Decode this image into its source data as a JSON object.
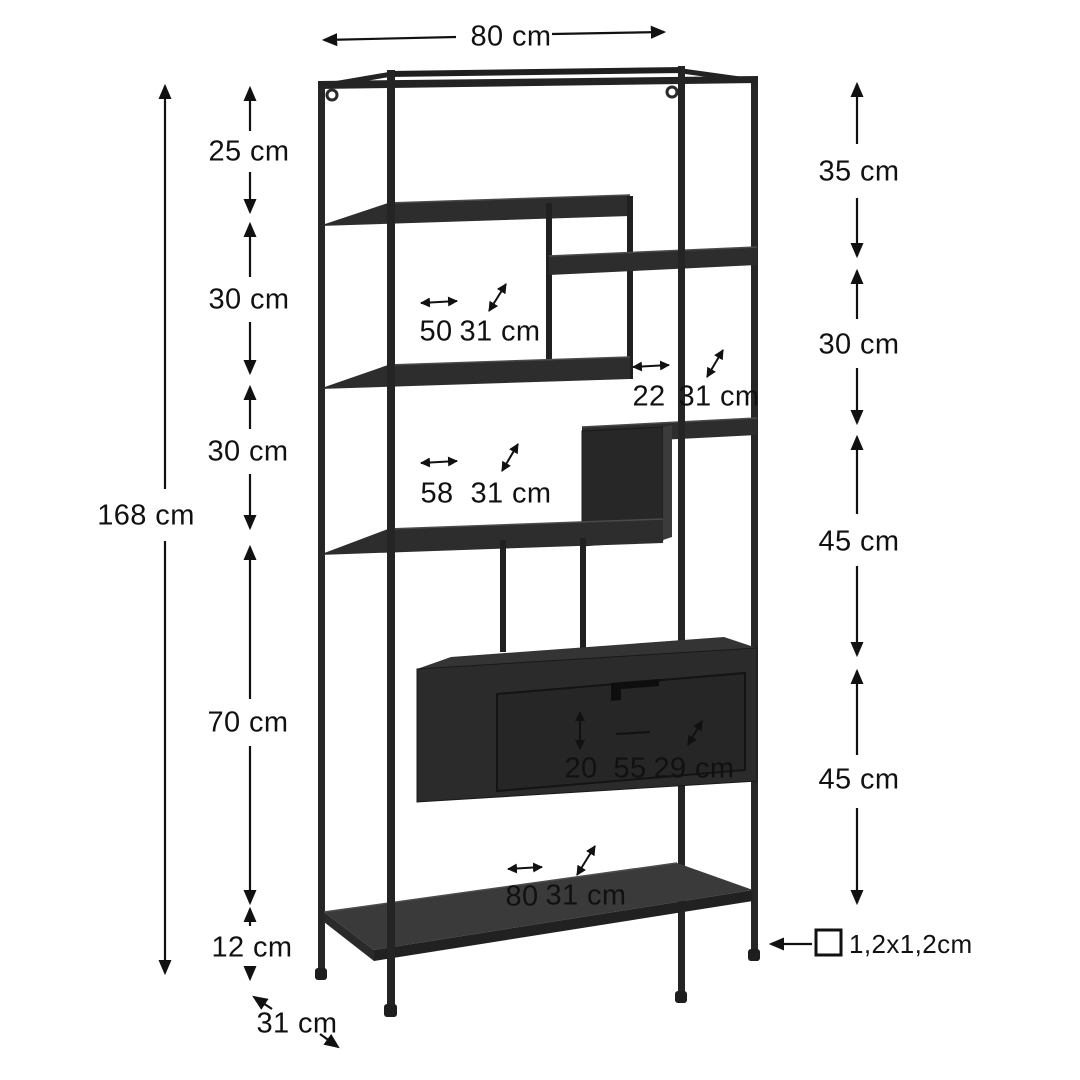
{
  "diagram": {
    "width_label": "80 cm",
    "height_label": "168 cm",
    "depth_label": "31 cm",
    "tube_label": "1,2x1,2cm",
    "left_segments": [
      "25 cm",
      "30 cm",
      "30 cm",
      "70 cm",
      "12 cm"
    ],
    "right_segments": [
      "35 cm",
      "30 cm",
      "45 cm",
      "45 cm"
    ],
    "annotations": [
      {
        "width": "50",
        "depth": "31 cm"
      },
      {
        "width": "22",
        "depth": "31 cm"
      },
      {
        "width": "58",
        "depth": "31 cm"
      },
      {
        "height": "20",
        "width": "55",
        "depth": "29 cm"
      },
      {
        "width": "80",
        "depth": "31 cm"
      }
    ],
    "colors": {
      "frame": "#2b2b2b",
      "annotation": "#111111",
      "background": "#ffffff"
    }
  }
}
